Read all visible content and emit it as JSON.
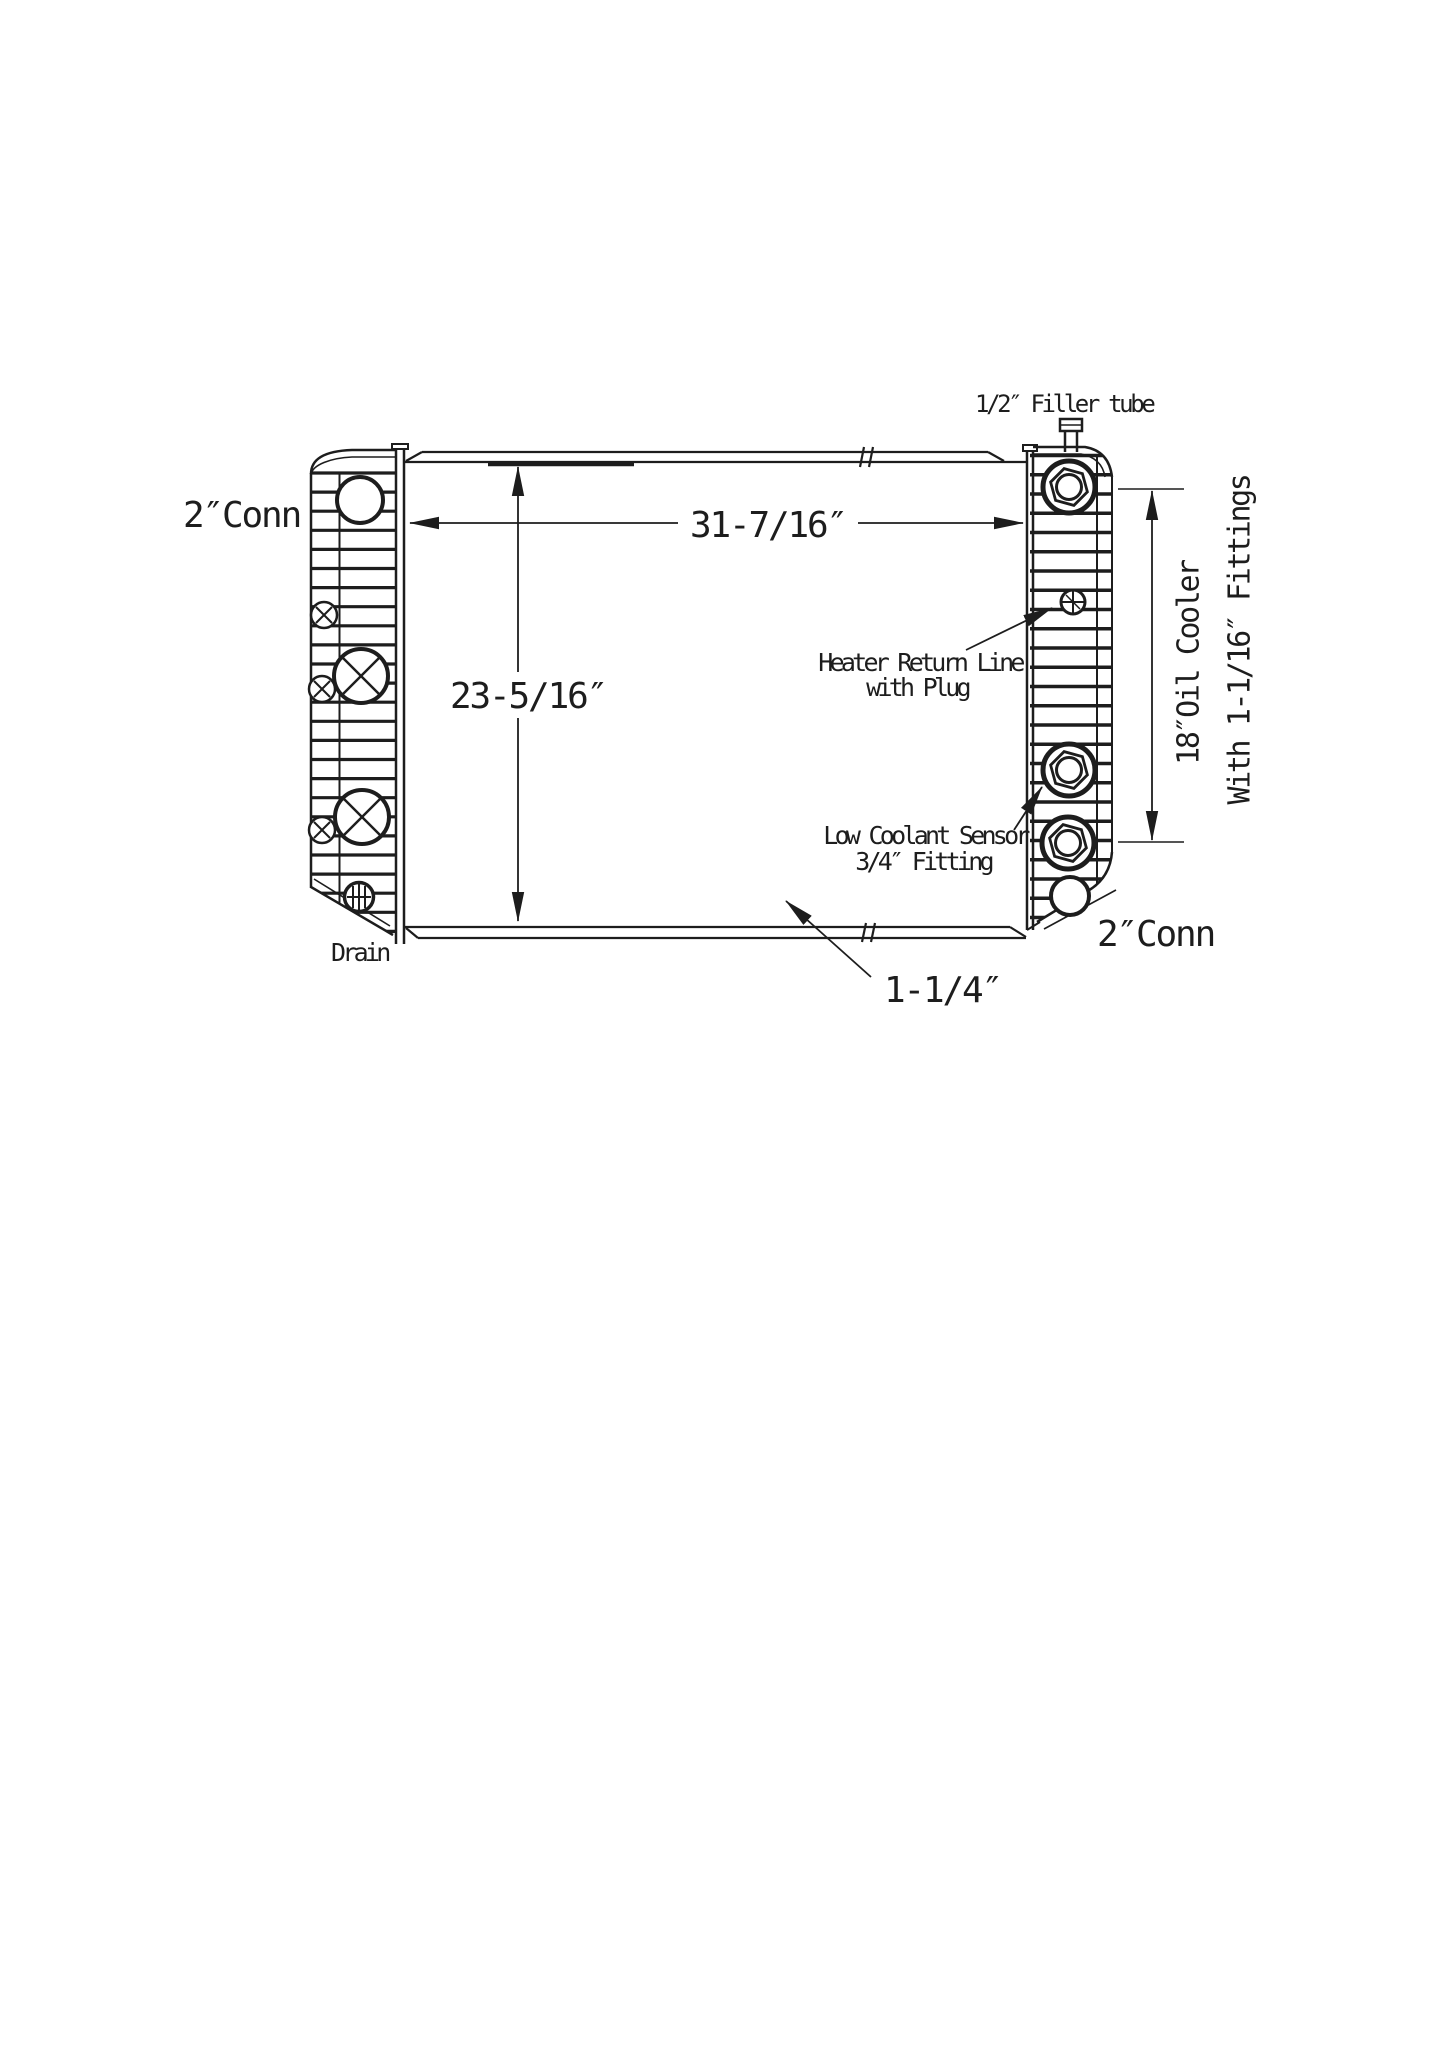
{
  "colors": {
    "background": "#ffffff",
    "ink": "#1d1d1d"
  },
  "labels": {
    "filler_tube": "1/2″ Filler tube",
    "conn_top_left": "2″Conn",
    "conn_bottom_right": "2″Conn",
    "heater_return_line_1": "Heater Return Line",
    "heater_return_line_2": "with Plug",
    "low_coolant_sensor_1": "Low Coolant Sensor",
    "low_coolant_sensor_2": "3/4″ Fitting",
    "drain": "Drain",
    "oil_cooler": "18″Oil Cooler",
    "oil_cooler_fittings": "With 1-1/16″ Fittings"
  },
  "dimensions": {
    "core_width": "31-7/16″",
    "core_height": "23-5/16″",
    "outlet_size": "1-1/4″"
  }
}
